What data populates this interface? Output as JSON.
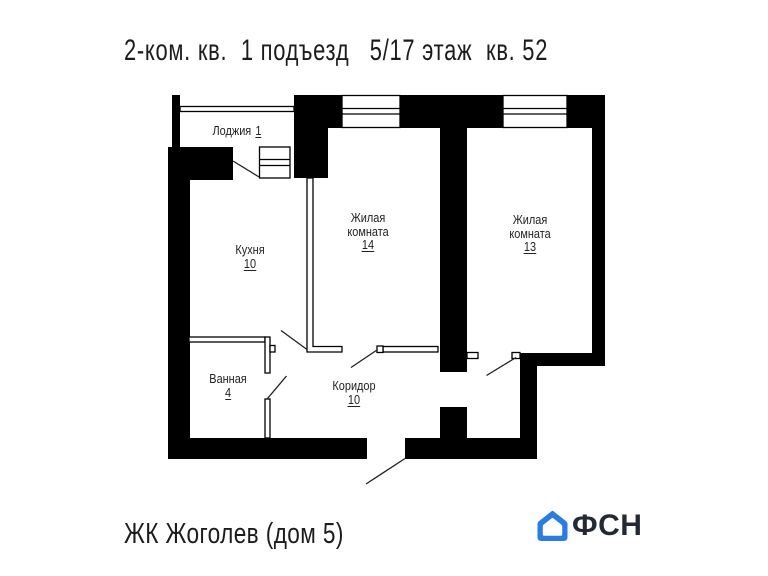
{
  "title": "2-ком. кв.  1 подъезд   5/17 этаж  кв. 52",
  "plan": {
    "rooms": {
      "loggia": {
        "name": "Лоджия",
        "area": "1"
      },
      "kitchen": {
        "name": "Кухня",
        "area": "10"
      },
      "living14": {
        "name_line1": "Жилая",
        "name_line2": "комната",
        "area": "14"
      },
      "living13": {
        "name_line1": "Жилая",
        "name_line2": "комната",
        "area": "13"
      },
      "bath": {
        "name": "Ванная",
        "area": "4"
      },
      "corridor": {
        "name": "Коридор",
        "area": "10"
      }
    }
  },
  "footer": {
    "project": "ЖК Жоголев (дом 5)",
    "logo": {
      "text": "ФСН",
      "house_color": "#2b7ce2",
      "text_color": "#242936"
    }
  },
  "colors": {
    "walls": "#000000",
    "background": "#ffffff"
  }
}
